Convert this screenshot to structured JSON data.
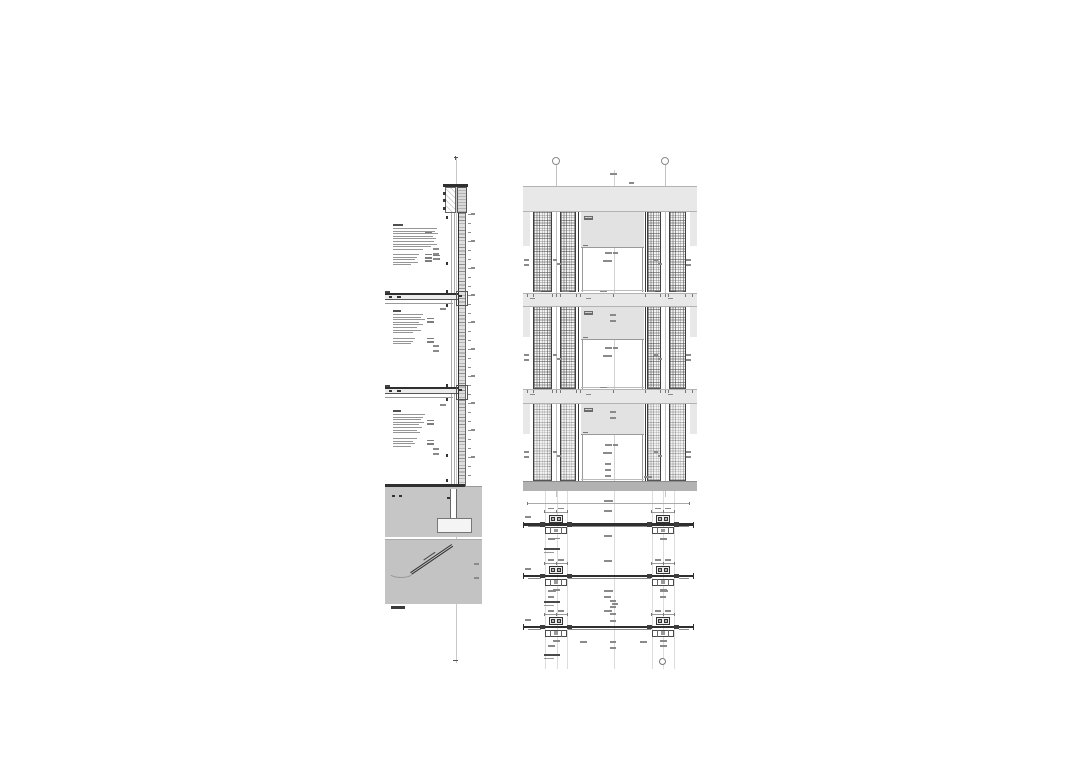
{
  "meta": {
    "description": "Architectural construction detail sheet: vertical facade wall section with material annotation blocks, three-storey facade elevation with gridded ventilation panel strips and window openings, foundation and ground details, and three horizontal plan section details of the window mullions."
  },
  "palette": {
    "ink": "#2f2f2f",
    "line": "#555555",
    "mid": "#8a8a8a",
    "value": "#7d7d7d",
    "faint": "#c9c9c9",
    "band": "#e8e8e8",
    "band_border": "#b3b3b3",
    "spandrel": "#e2e2e2",
    "ground": "#c6c6c6",
    "panel": "#c3c3c3",
    "base": "#b2b2b2",
    "hatch_bg": "#f3f3f3",
    "wall_fill": "#dedede",
    "footing": "#f4f4f4",
    "chip": "#6b6b6b",
    "white": "#ffffff"
  },
  "left_section": {
    "scale_label": "",
    "center_line": {
      "x": 455.5,
      "y1": 158,
      "y2": 663
    },
    "parapet": {
      "cap": {
        "x": 443,
        "y": 184,
        "w": 25,
        "h": 2.5
      },
      "cell_white": {
        "x": 445,
        "y": 187,
        "w": 11,
        "h": 26
      },
      "cell_hatch": {
        "x": 457,
        "y": 187,
        "w": 10,
        "h": 26
      },
      "bolt_x": 442.5,
      "bolts_y": [
        192,
        199,
        207
      ]
    },
    "wall": {
      "x": 458,
      "y": 213,
      "w": 8,
      "h": 273
    },
    "inner_lines": [
      450.5,
      453.5
    ],
    "dots": {
      "x": 445.8,
      "ys": [
        216,
        262,
        290,
        304,
        384,
        398,
        454,
        479
      ]
    },
    "right_ticks": {
      "x": 467.5,
      "y1": 214,
      "y2": 482,
      "step": 9
    },
    "slabs": [
      {
        "x": 385,
        "y": 293,
        "w": 73,
        "h": 7
      },
      {
        "x": 385,
        "y": 387,
        "w": 73,
        "h": 7
      }
    ],
    "junctions": [
      {
        "x": 456,
        "y": 291,
        "w": 12,
        "h": 15
      },
      {
        "x": 456,
        "y": 385,
        "w": 12,
        "h": 15
      }
    ],
    "ground": {
      "slab_line": {
        "x": 385,
        "y": 484,
        "w": 80,
        "h": 2.5
      },
      "fill": {
        "x": 385,
        "y": 487,
        "w": 97,
        "h": 50
      },
      "wall_cont": {
        "x": 450,
        "y": 489,
        "w": 7,
        "h": 31
      },
      "footing": {
        "x": 437,
        "y": 518,
        "w": 35,
        "h": 15
      },
      "dots": [
        [
          392,
          495
        ],
        [
          399,
          495
        ],
        [
          447,
          497
        ]
      ]
    },
    "pipe_panel": {
      "x": 385,
      "y": 539,
      "w": 97,
      "h": 65,
      "pipe": {
        "x": 411,
        "y": 572,
        "len": 50,
        "angle": -34.3
      },
      "curve": {
        "x": 388,
        "y": 566,
        "w": 26,
        "h": 12
      },
      "edge_marks": [
        [
          474,
          563
        ],
        [
          474,
          577
        ]
      ]
    },
    "scale_bar": {
      "x": 391,
      "y": 606,
      "w": 14,
      "h": 3
    },
    "text_blocks": [
      {
        "x": 393,
        "y": 224,
        "header_w": 10,
        "lines": [
          44,
          42,
          45,
          40,
          43,
          41,
          44,
          38,
          30
        ],
        "sub": [
          {
            "dy": 30,
            "lines": [
              26,
              24,
              22,
              25,
              18
            ]
          }
        ],
        "values": [
          {
            "x": 425,
            "dy": 8,
            "n": 1
          },
          {
            "x": 425,
            "dy": 30,
            "n": 3
          },
          {
            "x": 433,
            "dy": 31,
            "n": 2
          }
        ]
      },
      {
        "x": 393,
        "y": 310,
        "header_w": 8,
        "lines": [
          30,
          28,
          32,
          26,
          30,
          24,
          28,
          20
        ],
        "sub": [
          {
            "dy": 28,
            "lines": [
              22,
              20,
              18
            ]
          }
        ],
        "values": [
          {
            "x": 427,
            "dy": 8,
            "n": 2
          },
          {
            "x": 427,
            "dy": 28,
            "n": 2
          }
        ]
      },
      {
        "x": 393,
        "y": 410,
        "header_w": 8,
        "lines": [
          32,
          30,
          28,
          31,
          26,
          29,
          24,
          27
        ],
        "sub": [
          {
            "dy": 28,
            "lines": [
              24,
              20,
              22,
              18
            ]
          }
        ],
        "values": [
          {
            "x": 427,
            "dy": 10,
            "n": 2
          },
          {
            "x": 427,
            "dy": 30,
            "n": 2
          }
        ]
      }
    ],
    "micro": [
      [
        433,
        248
      ],
      [
        433,
        253
      ],
      [
        433,
        258
      ],
      [
        440,
        308
      ],
      [
        433,
        345
      ],
      [
        433,
        350
      ],
      [
        440,
        404
      ],
      [
        433,
        448
      ],
      [
        433,
        453
      ]
    ]
  },
  "elevation": {
    "x": 523,
    "w": 174,
    "grid_bubbles": [
      {
        "x": 556,
        "y": 161
      },
      {
        "x": 665,
        "y": 161
      }
    ],
    "grid_lines": [
      {
        "x": 556,
        "y1": 165,
        "y2": 497
      },
      {
        "x": 665,
        "y1": 165,
        "y2": 497
      }
    ],
    "center_line": {
      "x": 613.5,
      "y1": 170,
      "y2": 491
    },
    "bands": [
      {
        "y": 186,
        "h": 26
      },
      {
        "y": 293,
        "h": 14
      },
      {
        "y": 389,
        "h": 15
      }
    ],
    "returns_h": [
      34,
      30,
      30
    ],
    "base": {
      "y": 481,
      "h": 10
    },
    "strips": [
      {
        "x": 533,
        "w": 19
      },
      {
        "x": 560,
        "w": 16
      },
      {
        "x": 646.5,
        "w": 14
      },
      {
        "x": 669,
        "w": 16.5
      }
    ],
    "floors": [
      {
        "y": 212,
        "h": 80,
        "spandrel": 36,
        "dense": 0.5
      },
      {
        "y": 307,
        "h": 82,
        "spandrel": 33,
        "dense": 0.5
      },
      {
        "y": 404,
        "h": 77,
        "spandrel": 31,
        "dense": 0.3
      }
    ],
    "window": {
      "x": 580.5,
      "w": 63.5,
      "jamb_l": 577.5,
      "jamb_r": 644.5
    },
    "chip": {
      "dx": 3,
      "dy": 4,
      "w": 9,
      "h": 4
    },
    "top_micro": [
      [
        610,
        173,
        7
      ],
      [
        616,
        196,
        6
      ],
      [
        616,
        208,
        6
      ],
      [
        629,
        182,
        5
      ]
    ],
    "dim_rows": [
      295.5,
      391.5
    ],
    "dim_ticks_x": [
      527,
      533,
      552,
      556,
      560,
      576,
      580,
      613,
      645,
      660,
      665,
      668,
      685,
      692
    ],
    "dim_bars_x": [
      534,
      562,
      600,
      648,
      676
    ]
  },
  "plan_details": {
    "span": {
      "x1": 523,
      "x2": 693
    },
    "mullion_cx": [
      556,
      663
    ],
    "vlines": {
      "xs": [
        545,
        556.5,
        567,
        613.5,
        652,
        663,
        674
      ],
      "y1": 491,
      "y2": 669
    },
    "items": [
      {
        "line_y": 524.5,
        "label_y": 548,
        "label": "",
        "extra_bars": [
          [
            604,
            500,
            9
          ],
          [
            525,
            516,
            6
          ],
          [
            604,
            510,
            8
          ],
          [
            604,
            535,
            8
          ],
          [
            548,
            538,
            7
          ],
          [
            660,
            538,
            7
          ]
        ],
        "top_dim_y": 503
      },
      {
        "line_y": 576,
        "label_y": 601,
        "label": "",
        "extra_bars": [
          [
            604,
            560,
            8
          ],
          [
            525,
            568,
            6
          ],
          [
            548,
            590,
            8
          ],
          [
            604,
            590,
            9
          ],
          [
            660,
            590,
            8
          ],
          [
            604,
            596,
            7
          ],
          [
            548,
            596,
            6
          ],
          [
            660,
            596,
            6
          ],
          [
            612,
            603,
            6
          ]
        ]
      },
      {
        "line_y": 627,
        "label_y": 654,
        "label": "",
        "extra_bars": [
          [
            604,
            610,
            8
          ],
          [
            525,
            619,
            6
          ],
          [
            580,
            641,
            7
          ],
          [
            640,
            641,
            7
          ],
          [
            610,
            600,
            6
          ],
          [
            610,
            606,
            6
          ],
          [
            610,
            613,
            6
          ],
          [
            610,
            620,
            6
          ],
          [
            610,
            641,
            6
          ],
          [
            610,
            647,
            6
          ],
          [
            548,
            645,
            7
          ],
          [
            660,
            645,
            7
          ]
        ],
        "circle": {
          "x": 662,
          "y": 661
        }
      }
    ]
  }
}
